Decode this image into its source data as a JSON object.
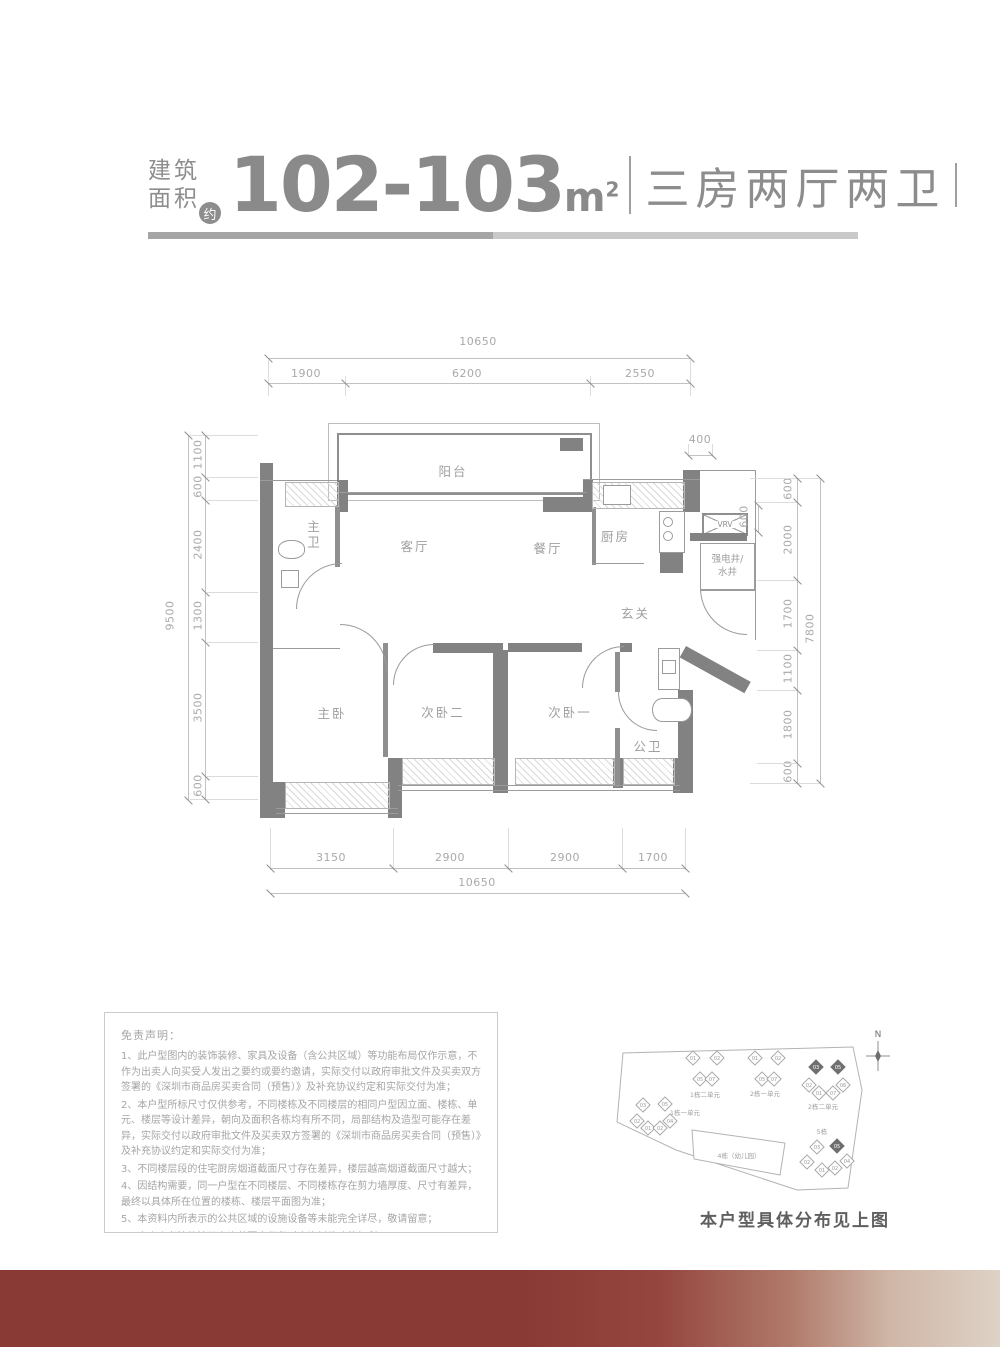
{
  "header": {
    "area_label_line1": "建筑",
    "area_label_line2": "面积",
    "approx_badge": "约",
    "area_value": "102-103",
    "area_unit": "m",
    "area_unit_sup": "2",
    "layout_type": "三房两厅两卫"
  },
  "floor_plan": {
    "rooms": {
      "balcony": "阳台",
      "master_bath": "主卫",
      "living": "客厅",
      "dining": "餐厅",
      "kitchen": "厨房",
      "utility_line1": "强电井/",
      "utility_line2": "水井",
      "foyer": "玄关",
      "master_bed": "主卧",
      "bedroom2": "次卧二",
      "bedroom1": "次卧一",
      "public_bath": "公卫",
      "vrv": "VRV"
    },
    "dims_top": {
      "total": "10650",
      "seg1": "1900",
      "seg2": "6200",
      "seg3": "2550"
    },
    "dims_bottom": {
      "seg1": "3150",
      "seg2": "2900",
      "seg3": "2900",
      "seg4": "1700",
      "total": "10650"
    },
    "dims_left": {
      "total": "9500",
      "seg1": "1100",
      "seg2": "600",
      "seg3": "2400",
      "seg4": "1300",
      "seg5": "3500",
      "seg6": "600"
    },
    "dims_right": {
      "total": "7800",
      "seg1": "600",
      "seg2": "2000",
      "seg3": "1700",
      "seg4": "1100",
      "seg5": "1800",
      "seg6": "600",
      "extra_width": "400",
      "extra_depth": "600"
    }
  },
  "disclaimer": {
    "title": "免责声明：",
    "items": [
      "1、此户型图内的装饰装修、家具及设备（含公共区域）等功能布局仅作示意，不作为出卖人向买受人发出之要约或要约邀请，实际交付以政府审批文件及买卖双方签署的《深圳市商品房买卖合同（预售）》及补充协议约定和实际交付为准；",
      "2、本户型所标尺寸仅供参考，不同楼栋及不同楼层的相同户型因立面、楼栋、单元、楼层等设计差异，朝向及面积各栋均有所不同，局部结构及造型可能存在差异，实际交付以政府审批文件及买卖双方签署的《深圳市商品房买卖合同（预售）》及补充协议约定和实际交付为准；",
      "3、不同楼层段的住宅厨房烟道截面尺寸存在差异，楼层越高烟道截面尺寸越大；",
      "4、因结构需要，同一户型在不同楼层、不同楼栋存在剪力墙厚度、尺寸有差异，最终以具体所在位置的楼栋、楼层平面图为准；",
      "5、本资料内所表示的公共区域的设施设备等未能完全详尽，敬请留意；",
      "6、出卖人在法律法规允许范围内保留对本资料修改的权利；",
      "7、本资料制作时间：2023年8月。"
    ]
  },
  "site_plan": {
    "north_label": "N",
    "clusters": [
      {
        "label": "1栋二单元",
        "units": [
          {
            "no": "01",
            "dark": false
          },
          {
            "no": "02",
            "dark": false
          },
          {
            "no": "05",
            "dark": false
          },
          {
            "no": "07",
            "dark": false
          }
        ]
      },
      {
        "label": "2栋一单元",
        "units": [
          {
            "no": "01",
            "dark": false
          },
          {
            "no": "02",
            "dark": false
          },
          {
            "no": "05",
            "dark": false
          },
          {
            "no": "07",
            "dark": false
          }
        ]
      },
      {
        "label": "2栋二单元",
        "units": [
          {
            "no": "03",
            "dark": true
          },
          {
            "no": "05",
            "dark": true
          },
          {
            "no": "02",
            "dark": false
          },
          {
            "no": "06",
            "dark": false
          },
          {
            "no": "01",
            "dark": false
          },
          {
            "no": "07",
            "dark": false
          }
        ]
      },
      {
        "label": "1栋一单元",
        "units": [
          {
            "no": "03",
            "dark": false
          },
          {
            "no": "05",
            "dark": false
          },
          {
            "no": "02",
            "dark": false
          },
          {
            "no": "01",
            "dark": false
          },
          {
            "no": "02",
            "dark": false
          },
          {
            "no": "04",
            "dark": false
          }
        ]
      },
      {
        "label": "4栋（幼儿园）",
        "units": []
      },
      {
        "label": "5栋",
        "units": [
          {
            "no": "03",
            "dark": false
          },
          {
            "no": "05",
            "dark": true
          },
          {
            "no": "02",
            "dark": false
          },
          {
            "no": "01",
            "dark": false
          },
          {
            "no": "02",
            "dark": false
          },
          {
            "no": "04",
            "dark": false
          }
        ]
      }
    ],
    "caption": "本户型具体分布见上图"
  },
  "colors": {
    "accent_bar_left": "#8a3a34",
    "accent_bar_right": "#ded2c6",
    "wall": "#828282",
    "dim_text": "#a9a9a9"
  }
}
